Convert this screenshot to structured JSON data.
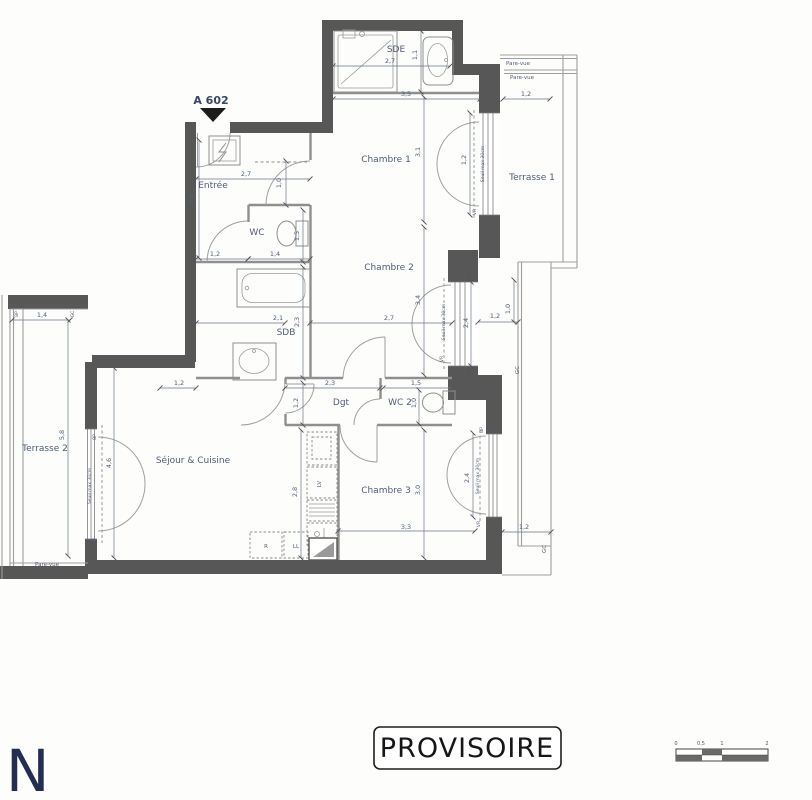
{
  "plan": {
    "unit": "A 602",
    "rooms": {
      "sde": "SDE",
      "chambre1": "Chambre 1",
      "entree": "Entrée",
      "wc": "WC",
      "chambre2": "Chambre 2",
      "sdb": "SDB",
      "dgt": "Dgt",
      "wc2": "WC 2",
      "sejour": "Séjour & Cuisine",
      "chambre3": "Chambre 3",
      "terrasse1": "Terrasse 1",
      "terrasse2": "Terrasse 2"
    },
    "annotations": {
      "pare_vue": "Pare-vue",
      "gc": "GC",
      "bp": "BP",
      "vr": "VR",
      "seuil": "Seuil max 30cm",
      "lv": "LV",
      "fridge": "R",
      "washer": "LL"
    },
    "dims": {
      "sde_w": "2,7",
      "sde_d": "1,1",
      "top_w": "3,5",
      "t1_w": "1,2",
      "ch1_h": "3,1",
      "win1": "1,2",
      "entree_w": "2,7",
      "entree_h": "3,0",
      "door1": "1,0",
      "wc_off": "1,2",
      "wc_w": "1,4",
      "wc_h": "1,5",
      "sdb_w": "2,1",
      "sdb_h": "2,3",
      "ch2_w": "2,7",
      "ch2_h": "3,4",
      "win2": "2,4",
      "gap_w": "1,2",
      "gap_h": "1,0",
      "dgt_w": "2,3",
      "dgt_h": "1,2",
      "wc2_w": "1,5",
      "wc2_h": "1,0",
      "sej_top": "1,2",
      "kitchen_h": "2,8",
      "sej_win": "4,6",
      "ch3_w": "3,3",
      "ch3_h": "3,0",
      "win3": "2,4",
      "t1low_w": "1,2",
      "t2_w": "1,4",
      "t2_h": "5,8"
    },
    "stamp": "PROVISOIRE",
    "logo": "N",
    "scalebar": {
      "t0": "0",
      "t05": "0,5",
      "t1": "1",
      "t2": "2"
    },
    "colors": {
      "wall": "#575757",
      "line": "#8f8f8f",
      "label": "#4e5d77",
      "logo": "#242e52",
      "stamp_border": "#1f1f1f"
    }
  }
}
